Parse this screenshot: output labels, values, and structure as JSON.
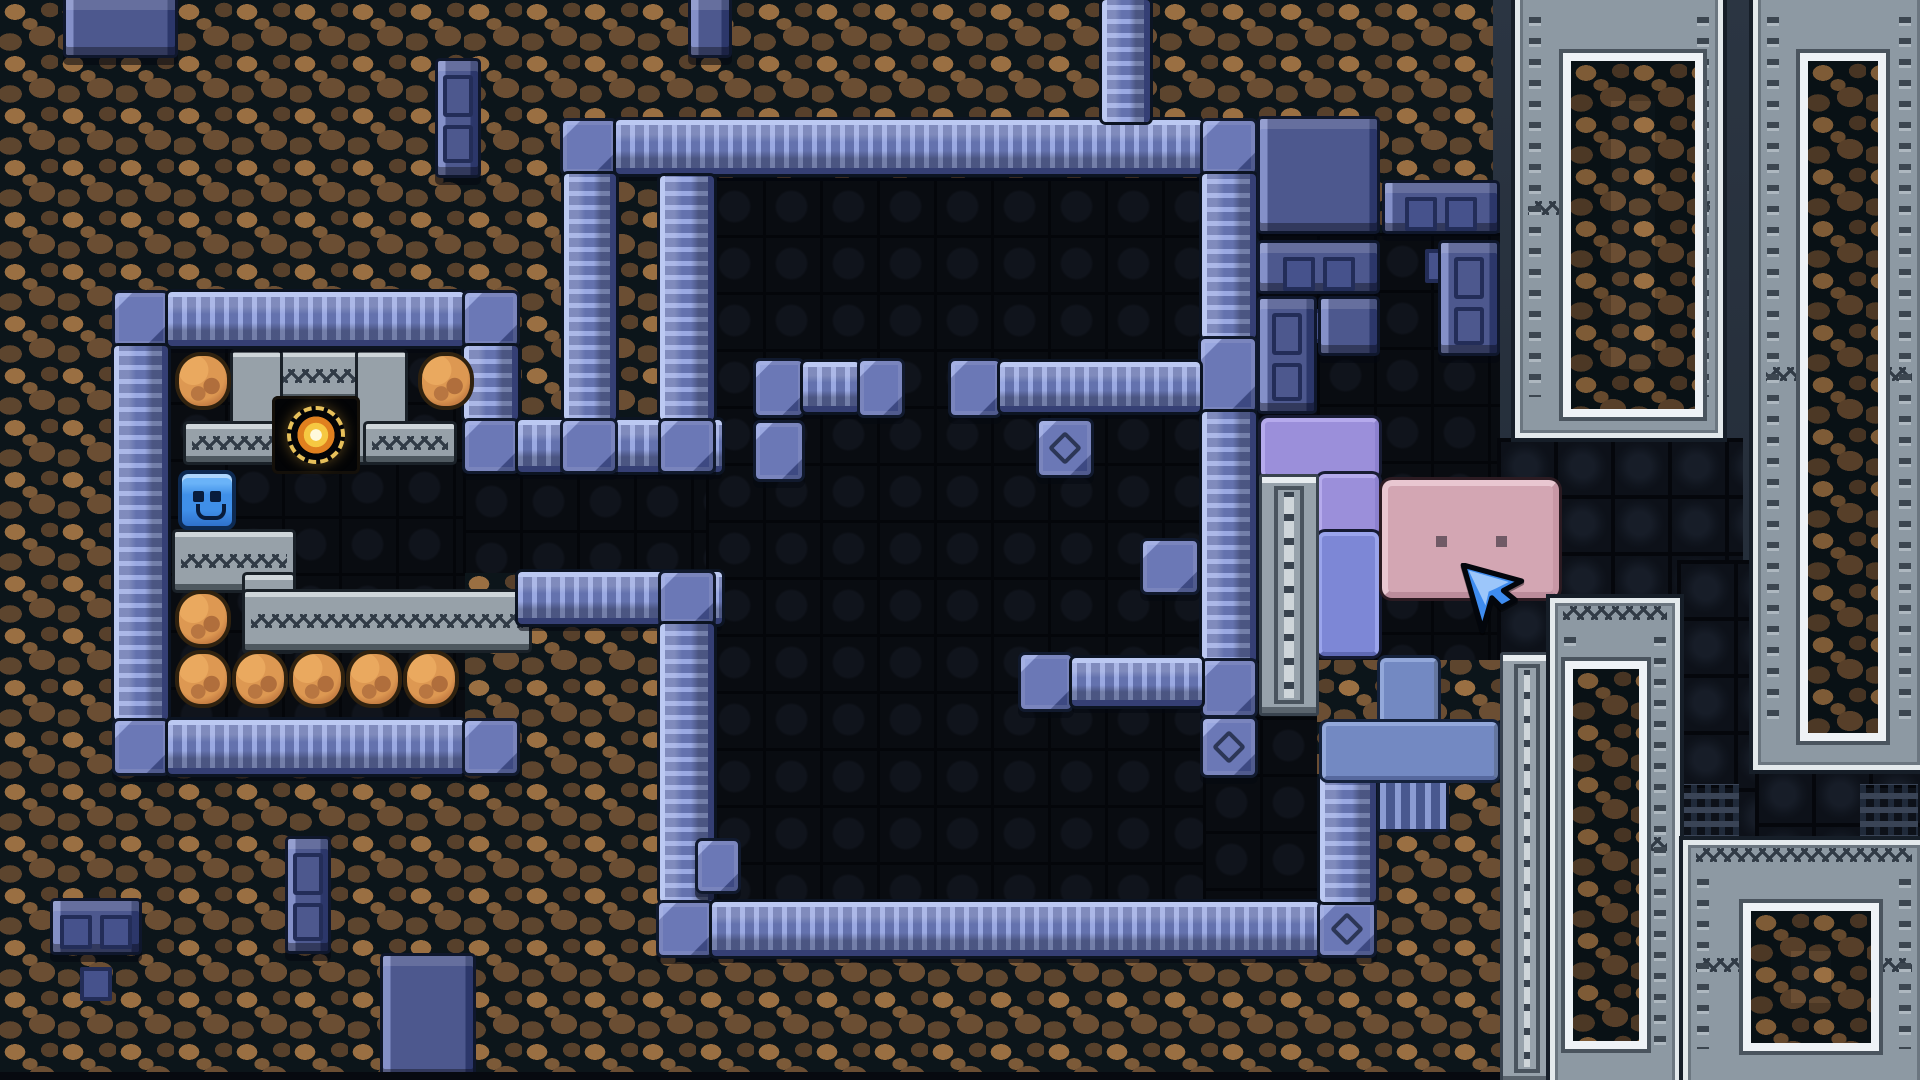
{
  "meta": {
    "app": "pixel-puzzle-game",
    "view": "level-screenshot",
    "width": 1920,
    "height": 1080,
    "tile_px": 57.6,
    "visible_text": "none"
  },
  "palette": {
    "dirt_light": "#9a6f42",
    "dirt_dark": "#5d452e",
    "cavern": "#090c11",
    "pipe_mid": "#6b78b6",
    "pipe_light": "#bcc9f2",
    "panel_navy": "#4d588e",
    "gray_band": "#97a1a9",
    "frame_silver": "#8d99a3",
    "frame_white": "#eef2f6",
    "boulder_orange": "#cd8447",
    "player_blue": "#3f8fe8",
    "orb_gold": "#f6c842",
    "lavender": "#9b8fda",
    "periwinkle": "#7d87d6",
    "steel_blue": "#7389c2",
    "pink": "#d3a6b3",
    "cursor_blue": "#3e8cf0"
  },
  "legend": {
    "dirt": "cave dirt background",
    "slate": "rock shelf behind metal frames",
    "cavern": "dark walkable floor",
    "brick": "dark navy brick floor",
    "pipe-h": "horizontal pipe wall",
    "pipe-v": "vertical pipe wall",
    "pipe-b": "pipe junction block",
    "pipe-bd": "pipe block with diamond mark",
    "ribcon": "ribbed pipe connector",
    "panel": "navy panel block",
    "panel-cut": "navy panel block clipped by screen edge",
    "panel-w3": "navy block with three windows",
    "panel-door": "navy block with door marks",
    "gray": "gray masonry band",
    "gray-zz": "gray masonry band with zigzag groove",
    "orbcell": "dark alcove cell",
    "orb": "golden orb collectible",
    "boulder": "orange boulder",
    "player": "blue smiley player block",
    "lav": "lavender L-piece",
    "peri": "periwinkle piece",
    "tblu": "steel-blue T-piece",
    "pink": "pink box with eyes",
    "ladder": "riveted silver column",
    "frame": "silver riveted frame with dirt window",
    "cursor": "mouse pointer",
    "strip": "dark screen-bottom strip"
  },
  "entities": [
    {
      "t": "dirt",
      "n": "dirt-background",
      "x": 0,
      "y": 0,
      "w": 1920,
      "h": 1080,
      "i": false
    },
    {
      "t": "slate",
      "n": "rock-shelf-background",
      "x": 1493,
      "y": 0,
      "w": 427,
      "h": 608,
      "i": false
    },
    {
      "t": "cavern",
      "n": "floor-left-room",
      "x": 168,
      "y": 345,
      "w": 297,
      "h": 377,
      "i": false
    },
    {
      "t": "cavern",
      "n": "floor-corridor",
      "x": 463,
      "y": 473,
      "w": 259,
      "h": 100,
      "i": false
    },
    {
      "t": "cavern",
      "n": "floor-big-room",
      "x": 706,
      "y": 178,
      "w": 497,
      "h": 722,
      "i": false
    },
    {
      "t": "cavern",
      "n": "floor-right-annex",
      "x": 1203,
      "y": 233,
      "w": 297,
      "h": 427,
      "i": false
    },
    {
      "t": "cavern",
      "n": "floor-right-annex-low",
      "x": 1203,
      "y": 660,
      "w": 114,
      "h": 240,
      "i": false
    },
    {
      "t": "brick",
      "n": "brick-floor",
      "x": 1497,
      "y": 438,
      "w": 246,
      "h": 164,
      "i": false
    },
    {
      "t": "brick",
      "n": "brick-floor",
      "x": 1677,
      "y": 560,
      "w": 80,
      "h": 286,
      "i": false
    },
    {
      "t": "brick",
      "n": "brick-floor",
      "x": 1755,
      "y": 766,
      "w": 170,
      "h": 80,
      "i": false
    },
    {
      "t": "brick",
      "n": "brick-floor",
      "x": 1497,
      "y": 596,
      "w": 62,
      "h": 64,
      "i": false
    },
    {
      "t": "brick-dotted",
      "n": "vent-brick",
      "x": 1860,
      "y": 784,
      "w": 58,
      "h": 56,
      "i": false
    },
    {
      "t": "brick-dotted",
      "n": "vent-brick",
      "x": 1677,
      "y": 784,
      "w": 62,
      "h": 54,
      "i": false
    },
    {
      "t": "gray-zz",
      "n": "alcove-top-band",
      "x": 233,
      "y": 352,
      "w": 172,
      "h": 48,
      "i": false
    },
    {
      "t": "gray",
      "n": "alcove-left-pillar",
      "x": 233,
      "y": 352,
      "w": 47,
      "h": 110,
      "i": false
    },
    {
      "t": "gray",
      "n": "alcove-right-pillar",
      "x": 358,
      "y": 352,
      "w": 47,
      "h": 110,
      "i": false
    },
    {
      "t": "gray-zz",
      "n": "alcove-left-wing",
      "x": 186,
      "y": 424,
      "w": 93,
      "h": 38,
      "i": false
    },
    {
      "t": "gray-zz",
      "n": "alcove-right-wing",
      "x": 366,
      "y": 424,
      "w": 88,
      "h": 38,
      "i": false
    },
    {
      "t": "gray-zz",
      "n": "ledge-band",
      "x": 175,
      "y": 532,
      "w": 118,
      "h": 58,
      "i": false
    },
    {
      "t": "gray",
      "n": "ledge-step",
      "x": 245,
      "y": 575,
      "w": 48,
      "h": 76,
      "i": false
    },
    {
      "t": "gray-zz",
      "n": "ledge-long-band",
      "x": 245,
      "y": 592,
      "w": 284,
      "h": 58,
      "i": false
    },
    {
      "t": "orbcell",
      "n": "orb-alcove-cell",
      "x": 272,
      "y": 396,
      "w": 88,
      "h": 78,
      "i": false
    },
    {
      "t": "orb",
      "n": "golden-orb",
      "x": 287,
      "y": 406,
      "w": 58,
      "h": 58,
      "i": true
    },
    {
      "t": "pipe-b",
      "n": "pipe-corner",
      "x": 112,
      "y": 290,
      "w": 58,
      "h": 58,
      "i": false
    },
    {
      "t": "pipe-h",
      "n": "pipe-wall",
      "x": 168,
      "y": 292,
      "w": 296,
      "h": 54,
      "i": false
    },
    {
      "t": "pipe-b",
      "n": "pipe-corner",
      "x": 462,
      "y": 290,
      "w": 58,
      "h": 58,
      "i": false
    },
    {
      "t": "pipe-v",
      "n": "pipe-wall",
      "x": 114,
      "y": 346,
      "w": 54,
      "h": 374,
      "i": false
    },
    {
      "t": "pipe-b",
      "n": "pipe-corner",
      "x": 112,
      "y": 718,
      "w": 58,
      "h": 58,
      "i": false
    },
    {
      "t": "pipe-h",
      "n": "pipe-wall",
      "x": 168,
      "y": 720,
      "w": 296,
      "h": 54,
      "i": false
    },
    {
      "t": "pipe-b",
      "n": "pipe-corner",
      "x": 462,
      "y": 718,
      "w": 58,
      "h": 58,
      "i": false
    },
    {
      "t": "pipe-v",
      "n": "pipe-wall",
      "x": 464,
      "y": 346,
      "w": 54,
      "h": 74,
      "i": false
    },
    {
      "t": "pipe-b",
      "n": "pipe-corner",
      "x": 462,
      "y": 418,
      "w": 58,
      "h": 56,
      "i": false
    },
    {
      "t": "pipe-h",
      "n": "pipe-wall",
      "x": 518,
      "y": 420,
      "w": 204,
      "h": 52,
      "i": false
    },
    {
      "t": "pipe-h",
      "n": "pipe-wall",
      "x": 518,
      "y": 572,
      "w": 204,
      "h": 52,
      "i": false
    },
    {
      "t": "pipe-b",
      "n": "pipe-corner",
      "x": 560,
      "y": 118,
      "w": 58,
      "h": 58,
      "i": false
    },
    {
      "t": "pipe-h",
      "n": "pipe-wall",
      "x": 616,
      "y": 120,
      "w": 586,
      "h": 54,
      "i": false
    },
    {
      "t": "pipe-b",
      "n": "pipe-corner",
      "x": 1200,
      "y": 118,
      "w": 58,
      "h": 58,
      "i": false
    },
    {
      "t": "pipe-v",
      "n": "pipe-wall",
      "x": 564,
      "y": 174,
      "w": 52,
      "h": 246,
      "i": false
    },
    {
      "t": "pipe-b",
      "n": "pipe-corner",
      "x": 560,
      "y": 418,
      "w": 58,
      "h": 56,
      "i": false
    },
    {
      "t": "pipe-v",
      "n": "pipe-wall",
      "x": 660,
      "y": 176,
      "w": 54,
      "h": 244,
      "i": false
    },
    {
      "t": "pipe-b",
      "n": "pipe-corner",
      "x": 658,
      "y": 418,
      "w": 58,
      "h": 56,
      "i": false
    },
    {
      "t": "pipe-b",
      "n": "pipe-corner",
      "x": 658,
      "y": 570,
      "w": 58,
      "h": 56,
      "i": false
    },
    {
      "t": "pipe-v",
      "n": "pipe-wall",
      "x": 660,
      "y": 624,
      "w": 54,
      "h": 278,
      "i": false
    },
    {
      "t": "pipe-b",
      "n": "pipe-corner",
      "x": 656,
      "y": 900,
      "w": 58,
      "h": 58,
      "i": false
    },
    {
      "t": "pipe-h",
      "n": "pipe-wall",
      "x": 712,
      "y": 902,
      "w": 607,
      "h": 54,
      "i": false
    },
    {
      "t": "pipe-bd",
      "n": "pipe-corner-diamond",
      "x": 1317,
      "y": 900,
      "w": 60,
      "h": 58,
      "i": false
    },
    {
      "t": "pipe-v",
      "n": "pipe-wall",
      "x": 1102,
      "y": 0,
      "w": 48,
      "h": 122,
      "i": false
    },
    {
      "t": "pipe-v",
      "n": "pipe-wall",
      "x": 1202,
      "y": 174,
      "w": 54,
      "h": 164,
      "i": false
    },
    {
      "t": "pipe-b",
      "n": "pipe-junction",
      "x": 1198,
      "y": 336,
      "w": 60,
      "h": 78,
      "i": false
    },
    {
      "t": "pipe-v",
      "n": "pipe-wall",
      "x": 1202,
      "y": 412,
      "w": 54,
      "h": 250,
      "i": false
    },
    {
      "t": "pipe-b",
      "n": "pipe-junction",
      "x": 1200,
      "y": 658,
      "w": 58,
      "h": 60,
      "i": false
    },
    {
      "t": "pipe-bd",
      "n": "pipe-block-diamond",
      "x": 1200,
      "y": 716,
      "w": 58,
      "h": 62,
      "i": false
    },
    {
      "t": "pipe-b",
      "n": "pipe-cap",
      "x": 948,
      "y": 358,
      "w": 54,
      "h": 60,
      "i": false
    },
    {
      "t": "pipe-h",
      "n": "pipe-wall",
      "x": 1000,
      "y": 362,
      "w": 200,
      "h": 50,
      "i": false
    },
    {
      "t": "pipe-bd",
      "n": "pipe-block-diamond",
      "x": 1036,
      "y": 418,
      "w": 58,
      "h": 60,
      "i": false
    },
    {
      "t": "pipe-b",
      "n": "pipe-cap",
      "x": 753,
      "y": 358,
      "w": 52,
      "h": 60,
      "i": false
    },
    {
      "t": "pipe-h",
      "n": "pipe-wall",
      "x": 803,
      "y": 362,
      "w": 56,
      "h": 50,
      "i": false
    },
    {
      "t": "pipe-b",
      "n": "pipe-cap",
      "x": 857,
      "y": 358,
      "w": 48,
      "h": 60,
      "i": false
    },
    {
      "t": "pipe-b",
      "n": "pipe-block",
      "x": 753,
      "y": 420,
      "w": 52,
      "h": 62,
      "i": false
    },
    {
      "t": "pipe-b",
      "n": "pipe-block",
      "x": 1140,
      "y": 538,
      "w": 60,
      "h": 57,
      "i": false
    },
    {
      "t": "pipe-b",
      "n": "pipe-block",
      "x": 695,
      "y": 838,
      "w": 46,
      "h": 56,
      "i": false
    },
    {
      "t": "pipe-b",
      "n": "pipe-cap",
      "x": 1018,
      "y": 652,
      "w": 56,
      "h": 60,
      "i": false
    },
    {
      "t": "pipe-h",
      "n": "pipe-wall",
      "x": 1072,
      "y": 658,
      "w": 130,
      "h": 48,
      "i": false
    },
    {
      "t": "pipe-v",
      "n": "pipe-wall",
      "x": 1320,
      "y": 776,
      "w": 56,
      "h": 126,
      "i": false
    },
    {
      "t": "ribcon",
      "n": "ribbed-connector",
      "x": 1377,
      "y": 778,
      "w": 72,
      "h": 54,
      "i": false
    },
    {
      "t": "panel-cut",
      "n": "panel-block",
      "x": 63,
      "y": 0,
      "w": 115,
      "h": 58,
      "i": false
    },
    {
      "t": "panel-door",
      "n": "door-block",
      "x": 435,
      "y": 58,
      "w": 46,
      "h": 120,
      "i": false
    },
    {
      "t": "panel-cut",
      "n": "panel-block",
      "x": 688,
      "y": 0,
      "w": 44,
      "h": 58,
      "i": false
    },
    {
      "t": "panel",
      "n": "panel-block",
      "x": 1257,
      "y": 116,
      "w": 123,
      "h": 118,
      "i": false
    },
    {
      "t": "panel-w3",
      "n": "window-block",
      "x": 1382,
      "y": 180,
      "w": 118,
      "h": 54,
      "i": false
    },
    {
      "t": "panel-w3",
      "n": "window-block",
      "x": 1257,
      "y": 240,
      "w": 123,
      "h": 54,
      "i": false
    },
    {
      "t": "panel-door",
      "n": "door-block",
      "x": 1438,
      "y": 240,
      "w": 62,
      "h": 116,
      "i": false
    },
    {
      "t": "panel-door",
      "n": "door-block",
      "x": 1257,
      "y": 296,
      "w": 60,
      "h": 118,
      "i": false
    },
    {
      "t": "panel",
      "n": "panel-block",
      "x": 1318,
      "y": 296,
      "w": 62,
      "h": 60,
      "i": false
    },
    {
      "t": "panel-w3",
      "n": "window-block",
      "x": 50,
      "y": 898,
      "w": 92,
      "h": 57,
      "i": false
    },
    {
      "t": "panel-door",
      "n": "door-block",
      "x": 285,
      "y": 836,
      "w": 46,
      "h": 118,
      "i": false
    },
    {
      "t": "panel",
      "n": "panel-block",
      "x": 380,
      "y": 953,
      "w": 96,
      "h": 127,
      "i": false
    },
    {
      "t": "boulder",
      "n": "boulder",
      "x": 175,
      "y": 352,
      "w": 56,
      "h": 58,
      "i": true
    },
    {
      "t": "boulder",
      "n": "boulder",
      "x": 418,
      "y": 352,
      "w": 56,
      "h": 58,
      "i": true
    },
    {
      "t": "boulder",
      "n": "boulder",
      "x": 175,
      "y": 590,
      "w": 56,
      "h": 58,
      "i": true
    },
    {
      "t": "boulder",
      "n": "boulder",
      "x": 175,
      "y": 650,
      "w": 56,
      "h": 58,
      "i": true
    },
    {
      "t": "boulder",
      "n": "boulder",
      "x": 232,
      "y": 650,
      "w": 56,
      "h": 58,
      "i": true
    },
    {
      "t": "boulder",
      "n": "boulder",
      "x": 289,
      "y": 650,
      "w": 56,
      "h": 58,
      "i": true
    },
    {
      "t": "boulder",
      "n": "boulder",
      "x": 346,
      "y": 650,
      "w": 56,
      "h": 58,
      "i": true
    },
    {
      "t": "boulder",
      "n": "boulder",
      "x": 403,
      "y": 650,
      "w": 56,
      "h": 58,
      "i": true
    },
    {
      "t": "player",
      "n": "player-block",
      "x": 178,
      "y": 470,
      "w": 58,
      "h": 60,
      "i": true
    },
    {
      "t": "lav",
      "n": "lavender-piece",
      "x": 1261,
      "y": 418,
      "w": 118,
      "h": 60,
      "i": true
    },
    {
      "t": "lav",
      "n": "lavender-piece",
      "x": 1318,
      "y": 474,
      "w": 61,
      "h": 62,
      "i": true
    },
    {
      "t": "peri",
      "n": "periwinkle-piece",
      "x": 1318,
      "y": 532,
      "w": 61,
      "h": 124,
      "i": true
    },
    {
      "t": "ladder",
      "n": "riveted-column",
      "x": 1259,
      "y": 474,
      "w": 60,
      "h": 242,
      "i": false
    },
    {
      "t": "tblu",
      "n": "t-piece-stem",
      "x": 1380,
      "y": 658,
      "w": 58,
      "h": 66,
      "i": true
    },
    {
      "t": "tblu",
      "n": "t-piece-bar",
      "x": 1322,
      "y": 722,
      "w": 176,
      "h": 58,
      "i": true
    },
    {
      "t": "pink",
      "n": "pink-box",
      "x": 1382,
      "y": 480,
      "w": 177,
      "h": 118,
      "i": true
    },
    {
      "t": "frame",
      "n": "metal-frame",
      "x": 1515,
      "y": -22,
      "w": 208,
      "h": 460,
      "fin": [
        43,
        70,
        124,
        348
      ],
      "i": false
    },
    {
      "t": "frame",
      "n": "metal-frame",
      "x": 1753,
      "y": -22,
      "w": 172,
      "h": 792,
      "fin": [
        42,
        70,
        70,
        672
      ],
      "i": false
    },
    {
      "t": "ladder",
      "n": "riveted-column",
      "x": 1500,
      "y": 652,
      "w": 54,
      "h": 433,
      "i": false
    },
    {
      "t": "frame",
      "n": "metal-frame",
      "x": 1550,
      "y": 598,
      "w": 130,
      "h": 492,
      "fin": [
        10,
        58,
        66,
        372
      ],
      "i": false
    },
    {
      "t": "frame",
      "n": "metal-frame",
      "x": 1683,
      "y": 840,
      "w": 242,
      "h": 250,
      "fin": [
        55,
        58,
        120,
        132
      ],
      "i": false
    },
    {
      "t": "strip",
      "n": "screen-bottom-strip",
      "x": 0,
      "y": 1072,
      "w": 1500,
      "h": 8,
      "i": false
    },
    {
      "t": "cursor",
      "n": "mouse-cursor-icon",
      "x": 1460,
      "y": 563,
      "w": 68,
      "h": 72,
      "i": false
    }
  ]
}
